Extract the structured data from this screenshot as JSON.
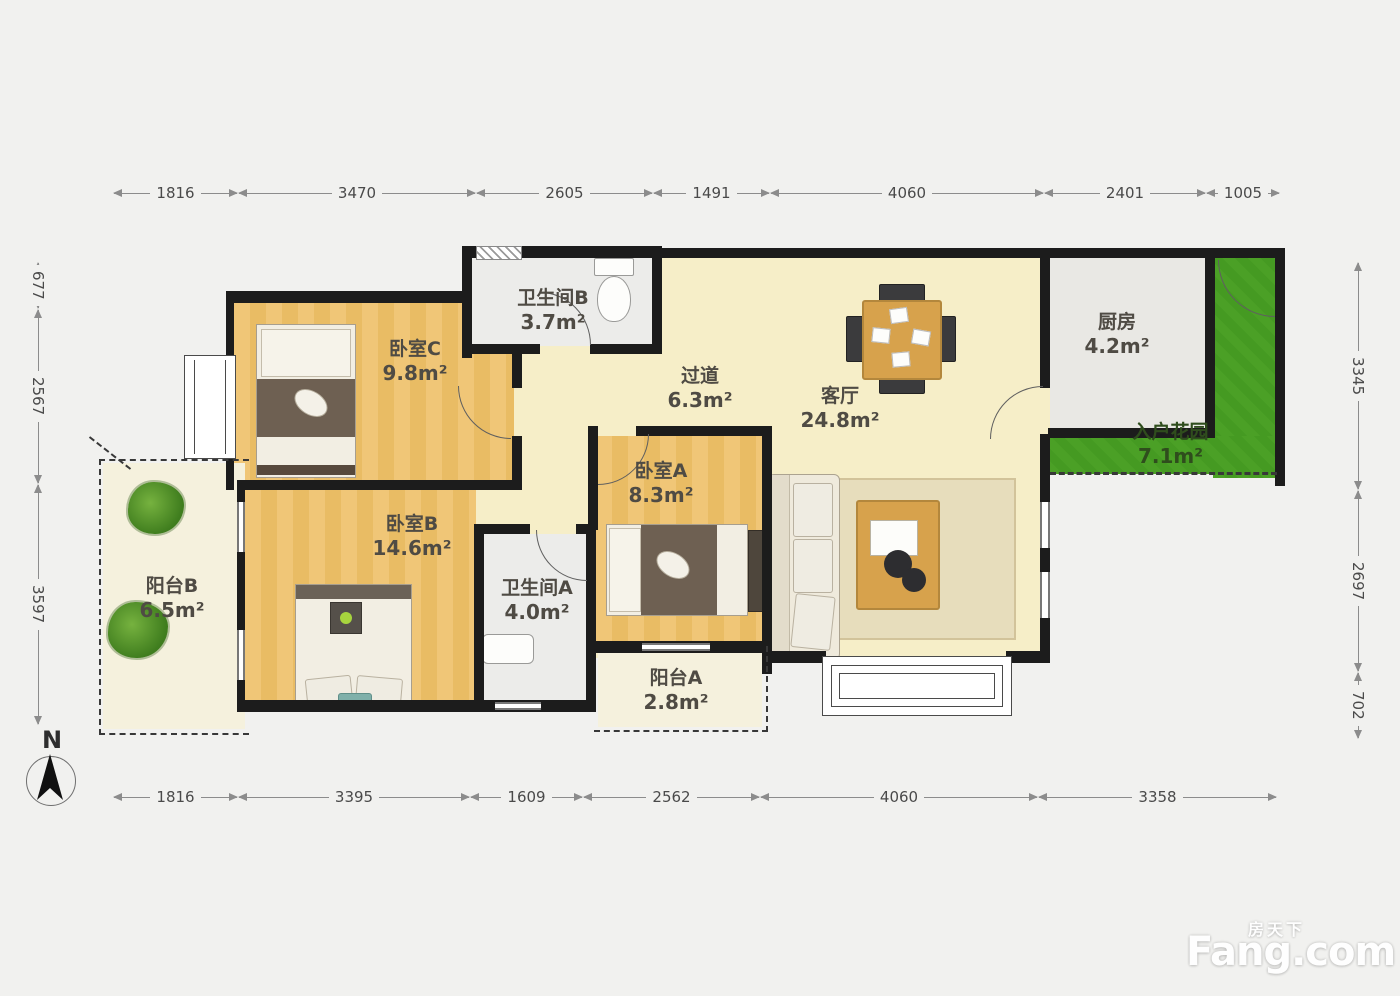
{
  "compass": {
    "label": "N"
  },
  "watermark": {
    "brand_cn": "房天下",
    "brand_en": "Fang.com"
  },
  "dimensions": {
    "top": [
      "1816",
      "3470",
      "2605",
      "1491",
      "4060",
      "2401",
      "1005"
    ],
    "bottom": [
      "1816",
      "3395",
      "1609",
      "2562",
      "4060",
      "3358"
    ],
    "left": [
      "677",
      "2567",
      "3597"
    ],
    "right": [
      "3345",
      "2697",
      "702"
    ]
  },
  "rooms": {
    "bedroom_c": {
      "name": "卧室C",
      "area": "9.8m²"
    },
    "bathroom_b": {
      "name": "卫生间B",
      "area": "3.7m²"
    },
    "hallway": {
      "name": "过道",
      "area": "6.3m²"
    },
    "living_room": {
      "name": "客厅",
      "area": "24.8m²"
    },
    "kitchen": {
      "name": "厨房",
      "area": "4.2m²"
    },
    "entry_garden": {
      "name": "入户花园",
      "area": "7.1m²"
    },
    "bedroom_b": {
      "name": "卧室B",
      "area": "14.6m²"
    },
    "bedroom_a": {
      "name": "卧室A",
      "area": "8.3m²"
    },
    "bathroom_a": {
      "name": "卫生间A",
      "area": "4.0m²"
    },
    "balcony_b": {
      "name": "阳台B",
      "area": "6.5m²"
    },
    "balcony_a": {
      "name": "阳台A",
      "area": "2.8m²"
    }
  },
  "colors": {
    "wall": "#1c1c1c",
    "wood_floor": "#efc36f",
    "living_floor": "#f6eec8",
    "garden_green": "#4ba026",
    "balcony_cream": "#f5f1dd",
    "bath_gray": "#ececea"
  }
}
